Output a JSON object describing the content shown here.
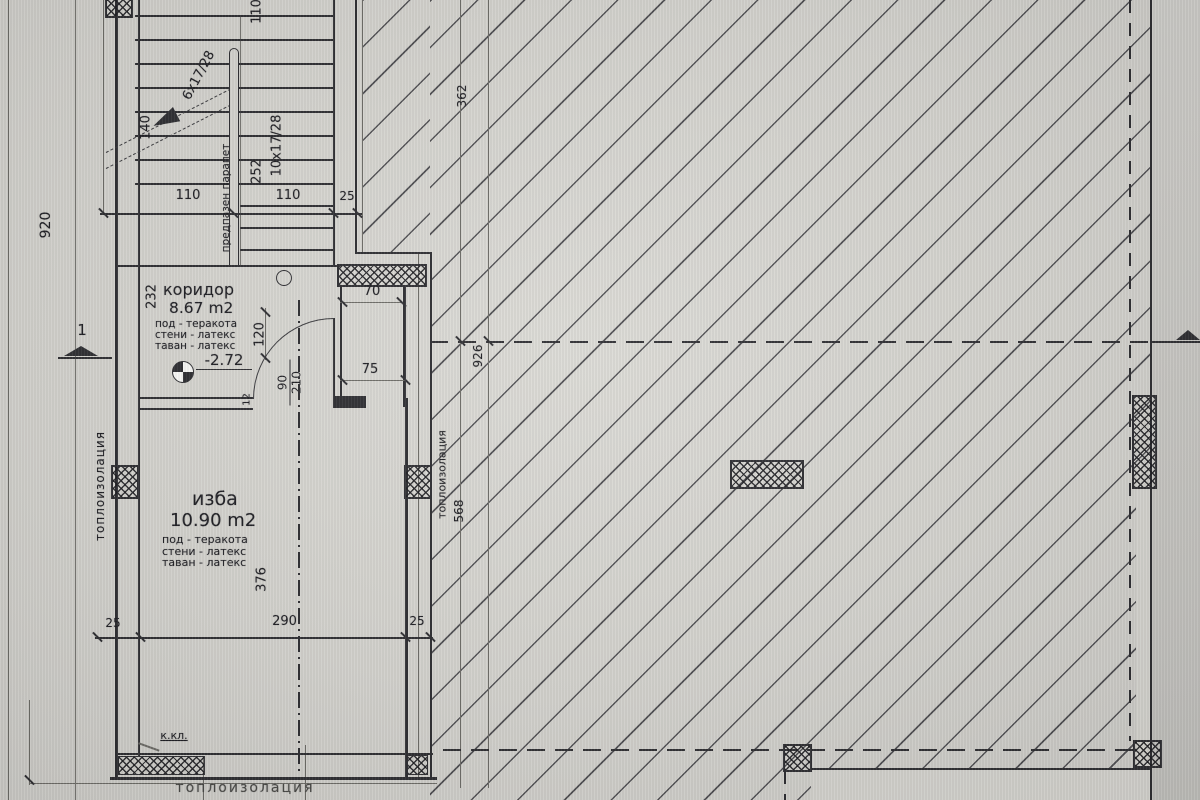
{
  "plan": {
    "colors": {
      "paper": "#d8d7d2",
      "ink": "#2f2f33",
      "margin_bg": "#c9c8c4"
    },
    "rooms": {
      "corridor": {
        "name": "коридор",
        "area": "8.67 m2",
        "floor": "под - теракота",
        "walls": "стени - латекс",
        "ceiling": "таван - латекс",
        "level": "-2.72"
      },
      "cellar": {
        "name": "изба",
        "area": "10.90 m2",
        "floor": "под - теракота",
        "walls": "стени - латекс",
        "ceiling": "таван - латекс"
      }
    },
    "stairs": {
      "flight_left": "6x17/28",
      "flight_right": "10x17/28",
      "railing": "предпазен парапет"
    },
    "labels": {
      "insulation": "топлоизолация",
      "kkl": "к.кл.",
      "section": "1"
    },
    "dims": {
      "left_total": "920",
      "top_cut": "110",
      "stair_left": "110",
      "stair_right": "110",
      "stair_wall": "25",
      "start": "140",
      "flight_len": "252",
      "corridor_len": "232",
      "door_clear": "120",
      "door_w": "90",
      "door_h": "210",
      "jamb": "12",
      "niche_top": "70",
      "niche_bottom": "75",
      "cellar_len": "376",
      "wall_l": "25",
      "cellar_w": "290",
      "wall_r": "25",
      "right_upper": "362",
      "right_total": "926",
      "right_lower": "568"
    }
  }
}
